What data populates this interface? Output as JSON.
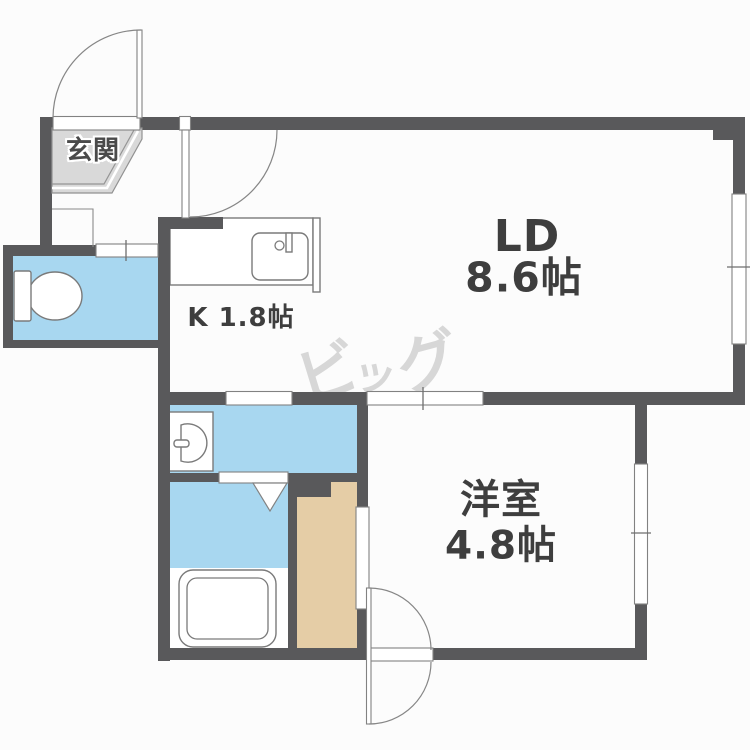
{
  "floor_plan": {
    "rooms": {
      "genkan": {
        "label": "玄関"
      },
      "living_dining": {
        "label": "LD",
        "size": "8.6帖"
      },
      "kitchen": {
        "label": "K 1.8帖"
      },
      "western_room": {
        "label": "洋室",
        "size": "4.8帖"
      }
    },
    "fixtures": [
      "toilet",
      "washbasin",
      "bathtub",
      "kitchen-sink",
      "closet"
    ],
    "watermark": {
      "text": "ビッグ",
      "chars": [
        "ビ",
        "ッ",
        "グ"
      ]
    },
    "colors": {
      "wall": "#59595b",
      "water_area": "#a8d7f0",
      "closet_floor": "#e5cda6",
      "genkan_floor": "#d9d9d9",
      "outline": "#7a7a7a",
      "label_text": "#3e3e3e",
      "watermark": "#d7d7d7",
      "background": "#fcfcfc"
    }
  }
}
